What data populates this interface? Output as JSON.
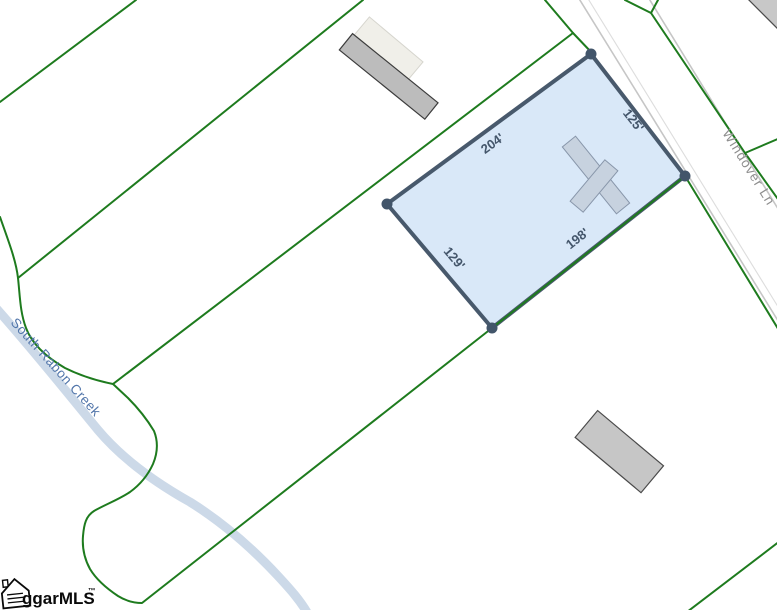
{
  "map": {
    "parcel": {
      "dim_nw": "204'",
      "dim_ne": "125'",
      "dim_se": "198'",
      "dim_sw": "129'"
    },
    "road": {
      "name": "Windover Ln"
    },
    "creek": {
      "name": "South Rabon Creek"
    },
    "logo": {
      "text": "ggarMLS",
      "tm": "™"
    },
    "colors": {
      "boundary_green": "#1e7b1e",
      "parcel_fill": "#d9e8f8",
      "parcel_border": "#48596c",
      "corner_dot": "#42556a",
      "creek": "#ccd9e8",
      "road_edge": "#c6c6c6"
    }
  }
}
